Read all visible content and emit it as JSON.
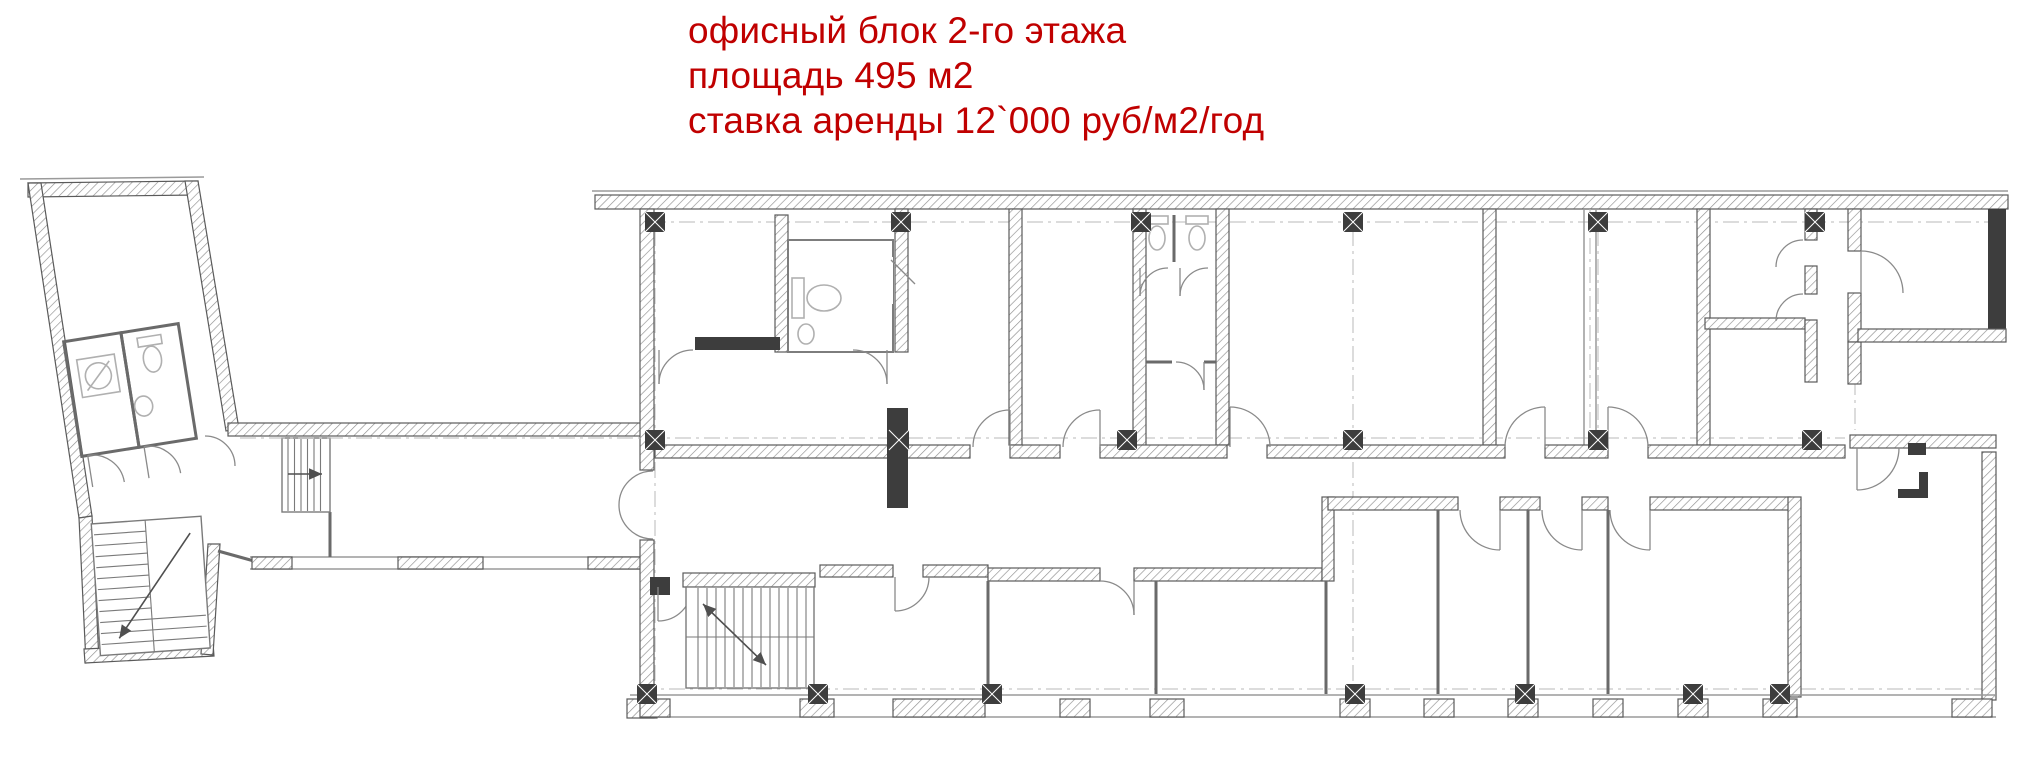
{
  "annotation": {
    "color": "#c00000",
    "lines": [
      "офисный блок 2-го этажа",
      "площадь 495 м2",
      "ставка аренды 12`000 руб/м2/год"
    ]
  },
  "plan": {
    "type": "architectural-floor-plan",
    "depicts": [
      "left-wing-with-wc-and-staircases",
      "connecting-corridor",
      "main-office-block",
      "central-corridor",
      "office-rooms",
      "wc-blocks",
      "main-staircase",
      "structural-columns",
      "window-facade"
    ]
  }
}
